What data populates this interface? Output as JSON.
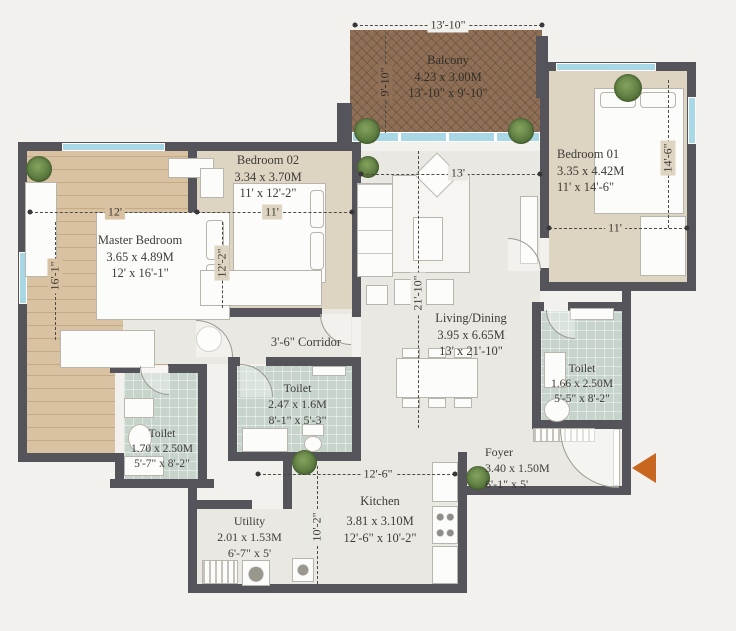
{
  "plan": {
    "type": "apartment-floor-plan",
    "corridor_label": "3'-6\" Corridor",
    "colors": {
      "wall": "#55545a",
      "balcony_deck": "#8f7057",
      "wood_floor": "#d9c2a1",
      "bedroom_floor": "#ded4c2",
      "living_floor": "#e9e8e3",
      "toilet_floor": "#c6d4cb",
      "window_glass": "#a8d8e6",
      "entry_arrow": "#c8661f",
      "text": "#3e3c38"
    },
    "rooms": [
      {
        "id": "balcony",
        "name": "Balcony",
        "dim_m": "4.23 x 3.00M",
        "dim_ft": "13'-10\" x 9'-10\""
      },
      {
        "id": "bedroom-01",
        "name": "Bedroom 01",
        "dim_m": "3.35 x 4.42M",
        "dim_ft": "11' x 14'-6\""
      },
      {
        "id": "bedroom-02",
        "name": "Bedroom 02",
        "dim_m": "3.34 x 3.70M",
        "dim_ft": "11' x 12'-2\""
      },
      {
        "id": "master-bedroom",
        "name": "Master Bedroom",
        "dim_m": "3.65 x 4.89M",
        "dim_ft": "12' x 16'-1\""
      },
      {
        "id": "living-dining",
        "name": "Living/Dining",
        "dim_m": "3.95 x 6.65M",
        "dim_ft": "13' x 21'-10\""
      },
      {
        "id": "toilet-middle",
        "name": "Toilet",
        "dim_m": "2.47 x 1.6M",
        "dim_ft": "8'-1\" x 5'-3\""
      },
      {
        "id": "toilet-left",
        "name": "Toilet",
        "dim_m": "1.70 x 2.50M",
        "dim_ft": "5'-7\" x 8'-2\""
      },
      {
        "id": "toilet-right",
        "name": "Toilet",
        "dim_m": "1.66 x 2.50M",
        "dim_ft": "5'-5\" x 8'-2\""
      },
      {
        "id": "foyer",
        "name": "Foyer",
        "dim_m": "3.40 x 1.50M",
        "dim_ft": "6'-1\" x 5'"
      },
      {
        "id": "kitchen",
        "name": "Kitchen",
        "dim_m": "3.81 x 3.10M",
        "dim_ft": "12'-6\" x 10'-2\""
      },
      {
        "id": "utility",
        "name": "Utility",
        "dim_m": "2.01 x 1.53M",
        "dim_ft": "6'-7\" x 5'"
      }
    ],
    "dimensions": [
      {
        "id": "balcony-width",
        "label": "13'-10\""
      },
      {
        "id": "balcony-depth",
        "label": "9'-10\""
      },
      {
        "id": "master-width",
        "label": "12'"
      },
      {
        "id": "master-depth",
        "label": "16'-1\""
      },
      {
        "id": "bedroom02-width",
        "label": "11'"
      },
      {
        "id": "bedroom02-depth",
        "label": "12'-2\""
      },
      {
        "id": "living-width",
        "label": "13'"
      },
      {
        "id": "living-depth",
        "label": "21'-10\""
      },
      {
        "id": "bedroom01-width",
        "label": "11'"
      },
      {
        "id": "bedroom01-depth",
        "label": "14'-6\""
      },
      {
        "id": "kitchen-width",
        "label": "12'-6\""
      },
      {
        "id": "kitchen-depth",
        "label": "10'-2\""
      }
    ]
  }
}
